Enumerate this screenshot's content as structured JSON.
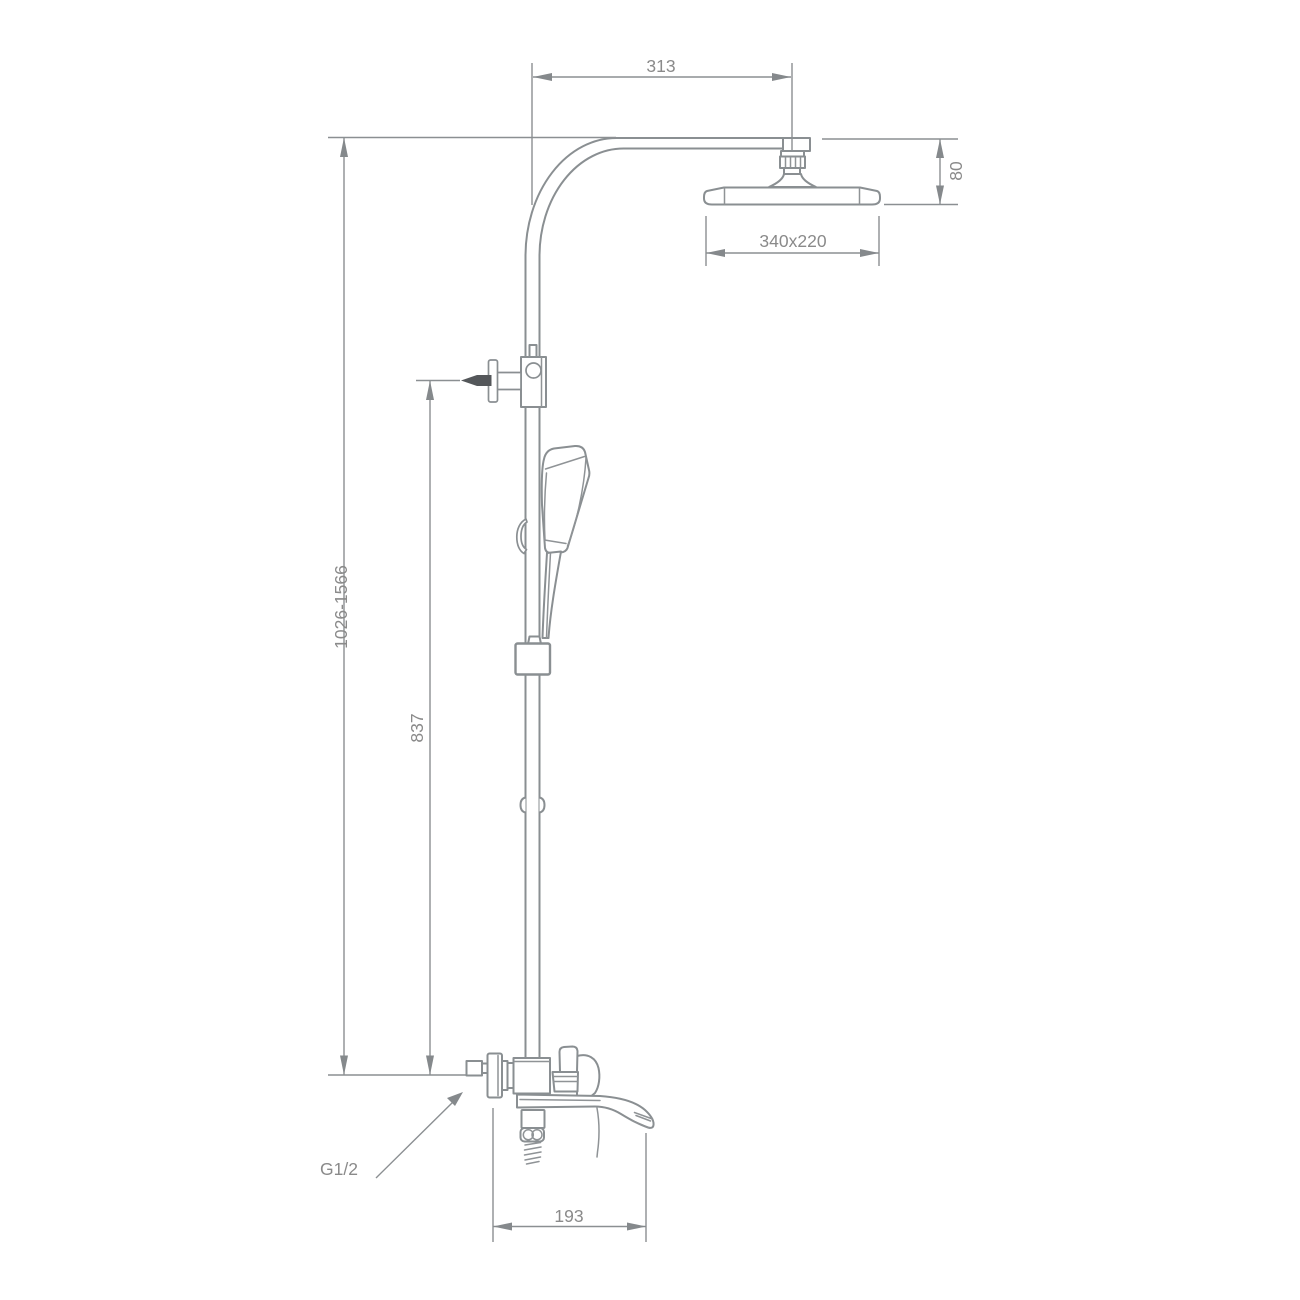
{
  "figure": {
    "type": "technical-drawing",
    "subject": "thermostatic shower column with rain head, hand shower and tub spout mixer"
  },
  "dimensions": {
    "arm_offset": "313",
    "head_drop": "80",
    "head_size": "340x220",
    "column_height_range": "1026-1566",
    "diverter_height": "837",
    "spout_reach": "193",
    "thread_label": "G1/2"
  },
  "colors": {
    "background": "#ffffff",
    "line": "#8a8f92",
    "dimension_line": "#8b8f92",
    "text": "#8a8a8a",
    "accent_dark": "#54575a"
  }
}
